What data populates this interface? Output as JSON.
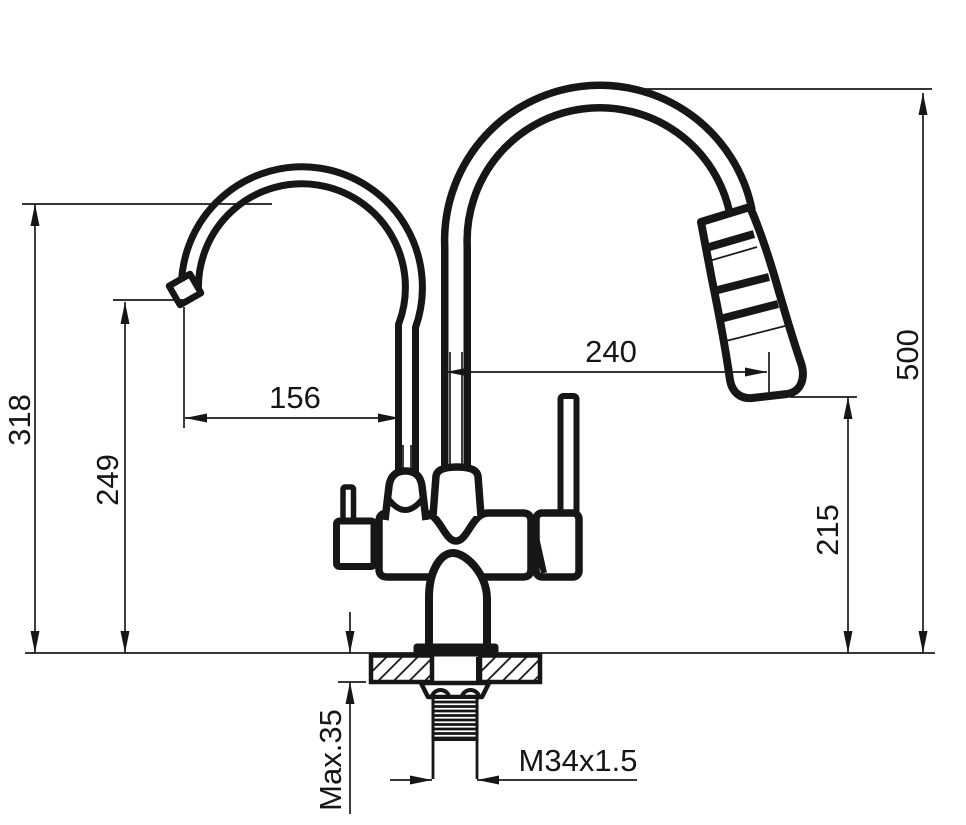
{
  "diagram": {
    "kind": "faucet-installation-dimension-drawing",
    "subject": "dual-spout kitchen faucet with pull-out spray head, deck mounted",
    "colors": {
      "line": "#161616",
      "background": "#ffffff"
    },
    "dimensions": [
      {
        "id": "small-spout-top-height",
        "label": "318",
        "orientation": "vertical"
      },
      {
        "id": "small-spout-outlet-height",
        "label": "249",
        "orientation": "vertical"
      },
      {
        "id": "small-spout-reach",
        "label": "156",
        "orientation": "horizontal"
      },
      {
        "id": "main-spout-reach",
        "label": "240",
        "orientation": "horizontal"
      },
      {
        "id": "overall-height",
        "label": "500",
        "orientation": "vertical"
      },
      {
        "id": "spray-outlet-height",
        "label": "215",
        "orientation": "vertical"
      },
      {
        "id": "max-deck-thickness",
        "label": "Max.35",
        "orientation": "vertical"
      },
      {
        "id": "mounting-thread-spec",
        "label": "M34x1.5",
        "orientation": "horizontal"
      }
    ]
  }
}
